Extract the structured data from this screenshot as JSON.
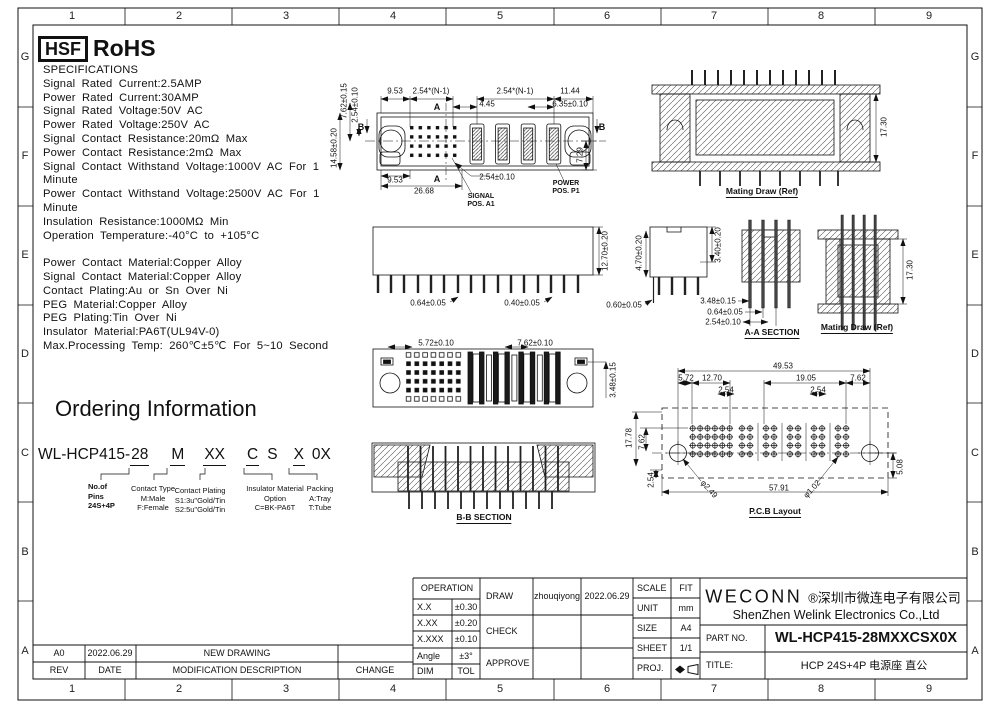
{
  "frame": {
    "columns": [
      "1",
      "2",
      "3",
      "4",
      "5",
      "6",
      "7",
      "8",
      "9"
    ],
    "rows": [
      "G",
      "F",
      "E",
      "D",
      "C",
      "B",
      "A"
    ]
  },
  "header": {
    "hsf": "HSF",
    "rohs": "RoHS"
  },
  "specs": {
    "lines": [
      "SPECIFICATIONS",
      "Signal Rated Current:2.5AMP",
      "Power Rated Current:30AMP",
      "Signal Rated Voltage:50V AC",
      "Power Rated Voltage:250V AC",
      "Signal Contact Resistance:20mΩ Max",
      "Power Contact Resistance:2mΩ Max",
      "Signal Contact Withstand Voltage:1000V AC For 1",
      "Minute",
      "Power Contact Withstand Voltage:2500V AC For 1",
      "Minute",
      "Insulation Resistance:1000MΩ Min",
      "Operation Temperature:-40°C to +105°C",
      "",
      "Power Contact Material:Copper Alloy",
      "Signal Contact Material:Copper Alloy",
      "Contact Plating:Au or Sn Over Ni",
      "PEG Material:Copper Alloy",
      "PEG Plating:Tin Over Ni",
      "Insulator Material:PA6T(UL94V-0)",
      "Max.Processing Temp: 260℃±5℃ For 5~10 Second"
    ]
  },
  "ordering": {
    "title": "Ordering Information",
    "part_base": "WL-HCP415-",
    "seg_pins": "28",
    "seg_type": "M",
    "seg_plating": "XX",
    "seg_c": "C",
    "seg_s": "S",
    "seg_x": "X",
    "seg_0x": "0X",
    "label_pins": "No.of\nPins\n24S+4P",
    "label_type": "Contact Type\nM:Male\nF:Female",
    "label_plating": "Contact Plating\nS1:3u\"Gold/Tin\nS2:5u\"Gold/Tin",
    "label_insulator": "Insulator Material\nOption\nC=BK-PA6T",
    "label_packing": "Packing\nA:Tray\nT:Tube"
  },
  "drawings": {
    "top_view": {
      "dims": [
        "9.53",
        "2.54*(N-1)",
        "2.54*(N-1)",
        "11.44",
        "4.45",
        "6.35±0.10",
        "7.62±0.15",
        "2.54±0.10",
        "14.58±0.20",
        "7.29",
        "9.53",
        "26.68",
        "2.54±0.10"
      ],
      "mark_a": "A",
      "mark_b": "B",
      "note_signal": "SIGNAL\nPOS. A1",
      "note_power": "POWER\nPOS. P1"
    },
    "mating_top": {
      "caption": "Mating Draw (Ref)",
      "dim": "17.30"
    },
    "front_view": {
      "dims": [
        "12.70±0.20",
        "0.64±0.05",
        "0.40±0.05"
      ]
    },
    "side_view": {
      "dims": [
        "4.70±0.20",
        "0.60±0.05",
        "3.40±0.20"
      ]
    },
    "aa_section": {
      "caption": "A-A SECTION",
      "dims": [
        "3.48±0.15",
        "0.64±0.05",
        "2.54±0.10"
      ]
    },
    "mating_side": {
      "caption": "Mating Draw (Ref)",
      "dim": "17.30"
    },
    "bottom_view": {
      "dims": [
        "5.72±0.10",
        "7.62±0.10",
        "3.48±0.15"
      ]
    },
    "bb_section": {
      "caption": "B-B SECTION"
    },
    "pcb": {
      "caption": "P.C.B Layout",
      "dims": [
        "49.53",
        "5.72",
        "12.70",
        "19.05",
        "7.62",
        "2.54",
        "2.54",
        "17.78",
        "7.62",
        "2.54",
        "57.91",
        "5.08"
      ],
      "holes": [
        "φ2.49",
        "φ1.02"
      ]
    }
  },
  "revision": {
    "entry": {
      "rev": "A0",
      "date": "2022.06.29",
      "desc": "NEW DRAWING",
      "change": ""
    },
    "headers": {
      "rev": "REV",
      "date": "DATE",
      "desc": "MODIFICATION DESCRIPTION",
      "change": "CHANGE"
    }
  },
  "title_block": {
    "operation": {
      "header": "OPERATION",
      "rows": [
        [
          "X.X",
          "±0.30"
        ],
        [
          "X.XX",
          "±0.20"
        ],
        [
          "X.XXX",
          "±0.10"
        ],
        [
          "Angle",
          "±3°"
        ],
        [
          "DIM",
          "TOL"
        ]
      ]
    },
    "signoff": {
      "draw": "DRAW",
      "draw_name": "zhouqiyong",
      "draw_date": "2022.06.29",
      "check": "CHECK",
      "approve": "APPROVE"
    },
    "meta": {
      "scale_label": "SCALE",
      "scale": "FIT",
      "unit_label": "UNIT",
      "unit": "mm",
      "size_label": "SIZE",
      "size": "A4",
      "sheet_label": "SHEET",
      "sheet": "1/1",
      "proj_label": "PROJ."
    },
    "company": {
      "logo": "WECONN",
      "cn": "®深圳市微连电子有限公司",
      "en": "ShenZhen Welink Electronics Co.,Ltd",
      "part_label": "PART NO.",
      "part_no": "WL-HCP415-28MXXCSX0X",
      "title_label": "TITLE:",
      "title": "HCP 24S+4P 电源座 直公"
    }
  }
}
